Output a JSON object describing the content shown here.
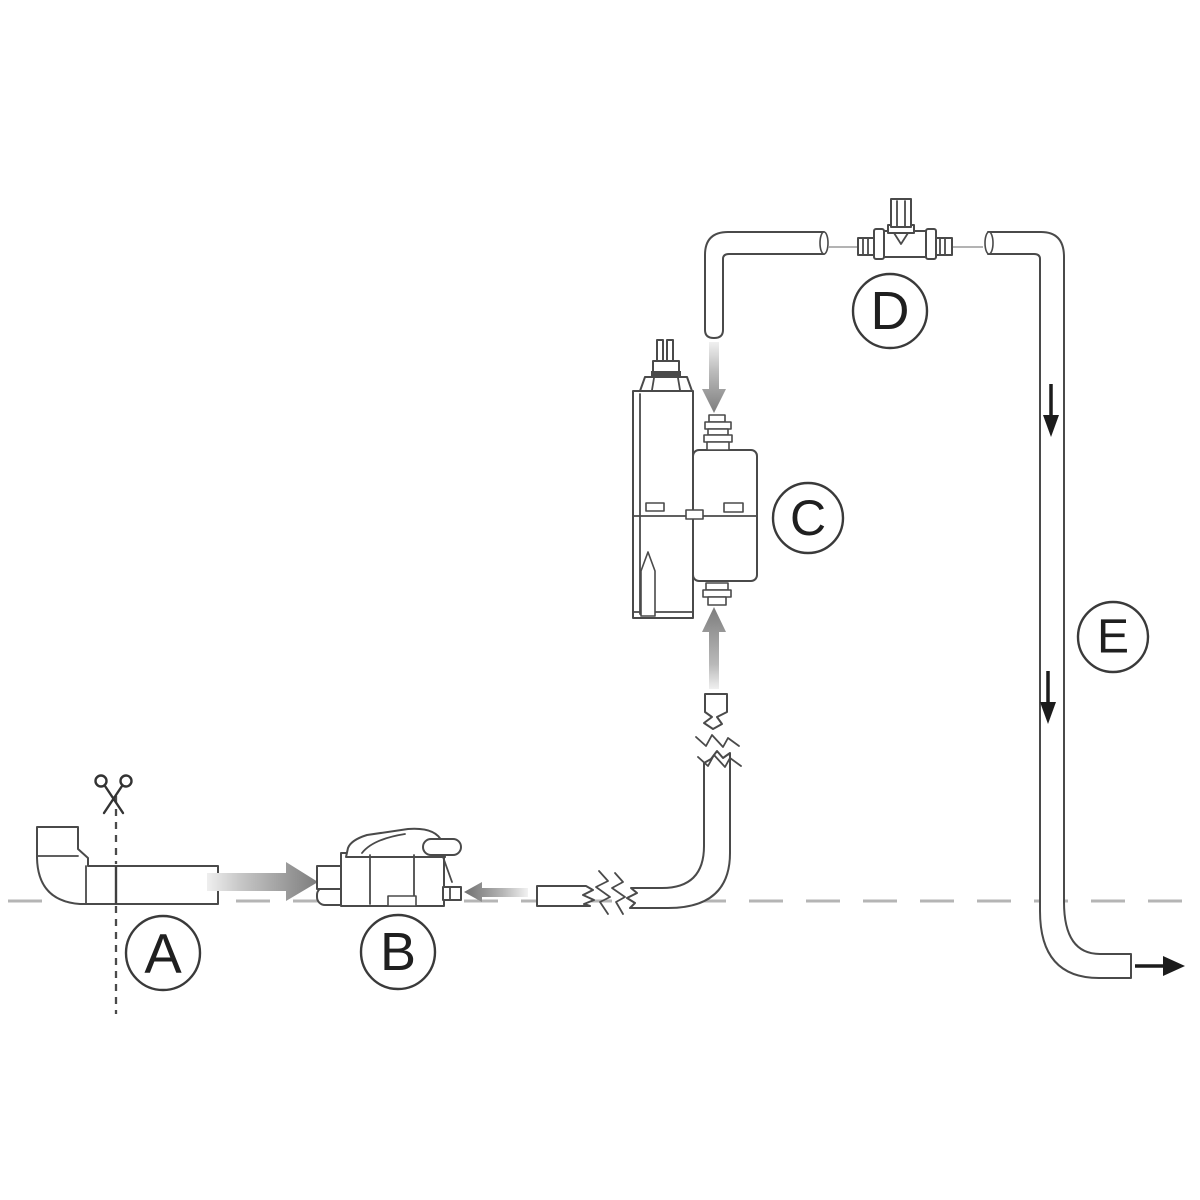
{
  "diagram": {
    "kind": "condensate-pump-installation-schematic",
    "background": "#ffffff",
    "colors": {
      "line": "#4a4a4a",
      "reference_dashed_line": "#b5b5b5",
      "flow_arrow_gray_dark": "#7d7d7d",
      "flow_arrow_gray_light": "#eeeeee",
      "flow_arrow_black": "#1c1c1c",
      "label_text": "#1f1f1f",
      "label_circle": "#3a3a3a"
    },
    "labels": {
      "a": "A",
      "b": "B",
      "c": "C",
      "d": "D",
      "e": "E"
    },
    "icons": {
      "scissors": "scissors-icon",
      "arrow_right": "flow-arrow-right",
      "arrow_left": "flow-arrow-left",
      "arrow_up": "flow-arrow-up",
      "arrow_down": "flow-arrow-down",
      "break_mark": "pipe-break-zigzag"
    }
  }
}
